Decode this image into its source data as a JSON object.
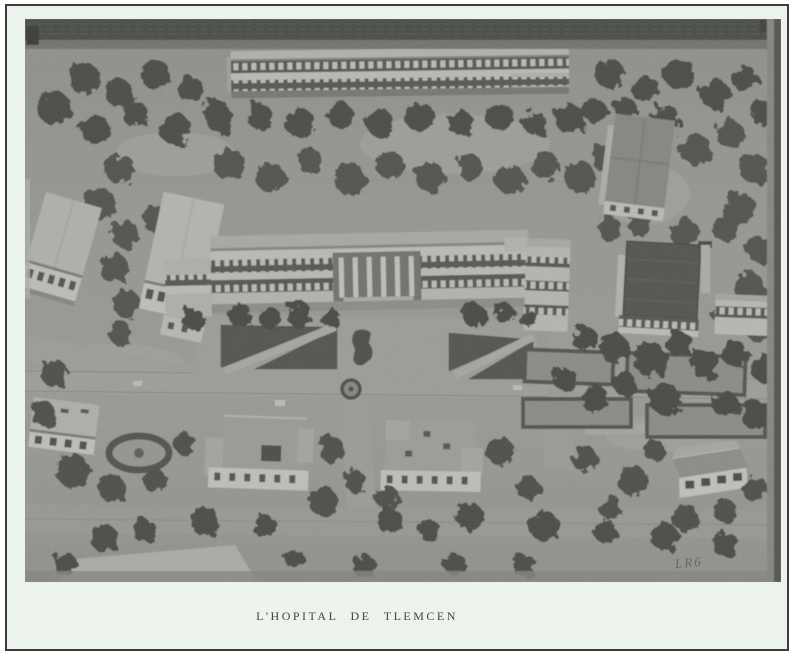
{
  "page": {
    "background": "#ffffff",
    "plate_background": "#ecf2ec",
    "frame_color": "#3b3b39"
  },
  "caption": {
    "text": "L'HOPITAL DE TLEMCEN"
  },
  "photo": {
    "kind": "black-and-white aerial photograph",
    "handwritten_mark": "LR6",
    "palette": {
      "vegetation_dark": "#2c2e28",
      "ground_mid": "#a5a69e",
      "road_light": "#b6b7af",
      "building_white": "#eceee6",
      "roof_gray": "#b3b4ac",
      "roof_dark": "#3a3c36",
      "hedge_band": "#2b2d27"
    },
    "scene": [
      "tree-lined-boundary",
      "long-ward-block-top",
      "main-hospital-building-with-colonnade",
      "left-pavilions",
      "dark-roof-service-block-and-chimney",
      "formal-garden-diagonal-paths-fountain",
      "detached-villas-bottom",
      "perimeter-road-with-trees"
    ]
  }
}
